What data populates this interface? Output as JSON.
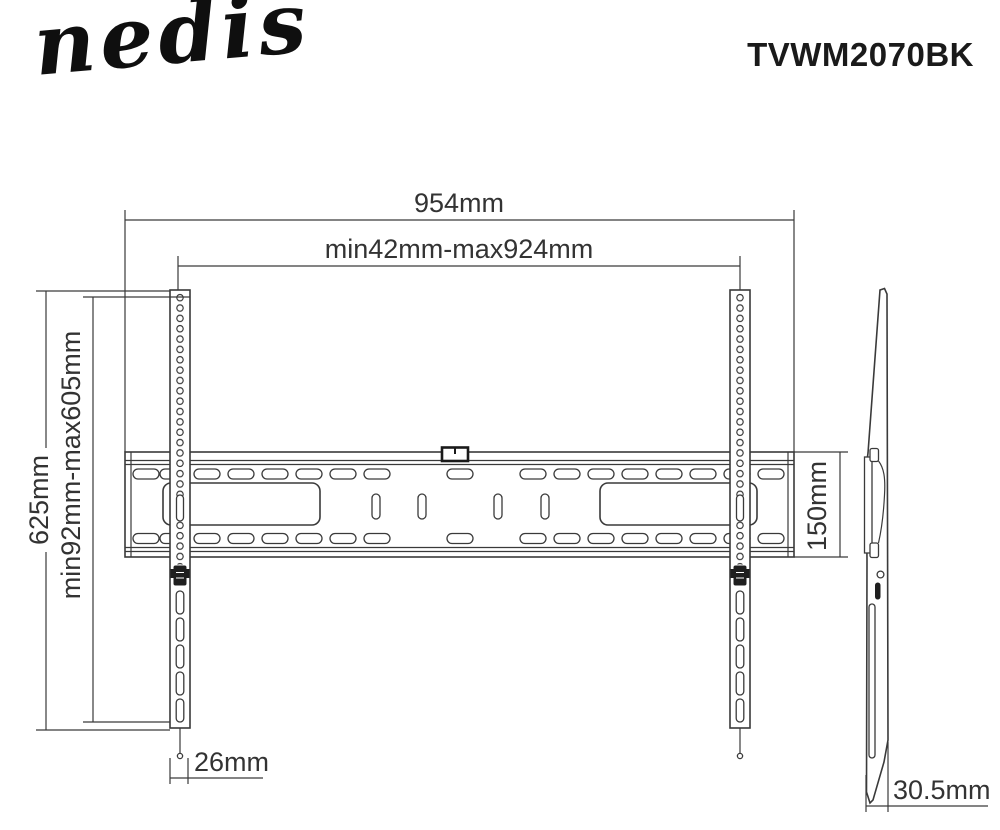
{
  "header": {
    "brand": "nedis",
    "product_code": "TVWM2070BK"
  },
  "front_view": {
    "dim_total_width": "954mm",
    "dim_hole_pattern_width": "min42mm-max924mm",
    "dim_total_height": "625mm",
    "dim_hole_pattern_height": "min92mm-max605mm",
    "dim_wall_plate_height": "150mm",
    "dim_rail_width": "26mm"
  },
  "side_view": {
    "dim_depth": "30.5mm"
  },
  "colors": {
    "line": "#3a3a3a",
    "text": "#333333",
    "accent_dark": "#1f1f1f",
    "background": "#ffffff"
  }
}
